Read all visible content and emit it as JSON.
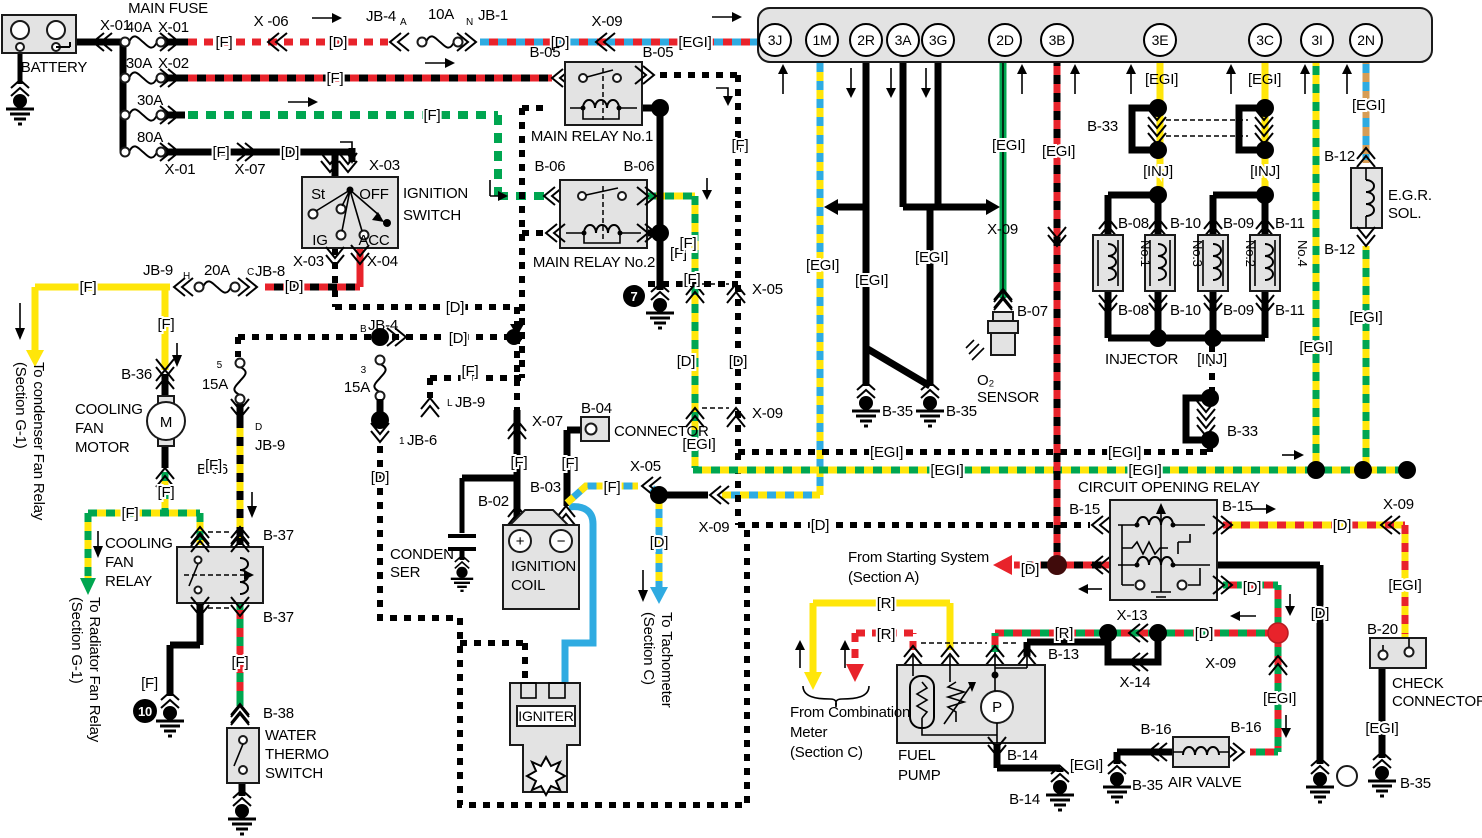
{
  "labels": {
    "F": "[F]",
    "D": "[D]",
    "R": "[R]",
    "EGI": "[EGI]",
    "INJ": "[INJ]"
  },
  "conn": {
    "X01": "X-01",
    "X02": "X-02",
    "X03": "X-03",
    "X04": "X-04",
    "X05": "X-05",
    "X06": "X -06",
    "X07": "X-07",
    "X09": "X-09",
    "X13": "X-13",
    "X14": "X-14",
    "JB1": "JB-1",
    "JB4": "JB-4",
    "JB6": "JB-6",
    "JB8": "JB-8",
    "JB9": "JB-9",
    "B02": "B-02",
    "B03": "B-03",
    "B04": "B-04",
    "B05": "B-05",
    "B06": "B-06",
    "B07": "B-07",
    "B08": "B-08",
    "B09": "B-09",
    "B10": "B-10",
    "B11": "B-11",
    "B12": "B-12",
    "B13": "B-13",
    "B14": "B-14",
    "B15": "B-15",
    "B16": "B-16",
    "B20": "B-20",
    "B33": "B-33",
    "B35": "B-35",
    "B36": "B-36",
    "B37": "B-37",
    "B38": "B-38"
  },
  "fuse": {
    "MAIN": "MAIN FUSE",
    "A10": "10A",
    "A15": "15A",
    "A20": "20A",
    "A30": "30A",
    "A40": "40A",
    "A80": "80A"
  },
  "sub": {
    "A": "A",
    "N": "N",
    "B": "B",
    "C": "C",
    "H": "H",
    "D": "D",
    "L": "L",
    "n1": "1",
    "n3": "3",
    "n5": "5"
  },
  "comp": {
    "battery": "BATTERY",
    "ign1": "IGNITION",
    "ign2": "SWITCH",
    "relay1": "MAIN RELAY No.1",
    "relay2": "MAIN RELAY No.2",
    "cfm1": "COOLING",
    "cfm2": "FAN",
    "cfm3": "MOTOR",
    "cfr1": "COOLING",
    "cfr2": "FAN",
    "cfr3": "RELAY",
    "wts1": "WATER",
    "wts2": "THERMO",
    "wts3": "SWITCH",
    "cond1": "CONDEN",
    "cond2": "SER",
    "coil1": "IGNITION",
    "coil2": "COIL",
    "igniter": "IGNITER",
    "connector": "CONNECTOR",
    "injector": "INJECTOR",
    "no1": "No.1",
    "no3": "No.3",
    "no2": "No.2",
    "no4": "No.4",
    "egr1": "E.G.R.",
    "egr2": "SOL.",
    "o2a": "O₂",
    "o2b": "SENSOR",
    "cor": "CIRCUIT OPENING RELAY",
    "fp1": "FUEL",
    "fp2": "PUMP",
    "av": "AIR VALVE",
    "cc1": "CHECK",
    "cc2": "CONNECTOR",
    "m": "M",
    "p": "P"
  },
  "sw": {
    "st": "St",
    "off": "OFF",
    "ig": "IG",
    "acc": "ACC"
  },
  "num": {
    "n7": "7",
    "n10": "10"
  },
  "ecu": {
    "pins": [
      "3J",
      "1M",
      "2R",
      "3A",
      "3G",
      "2D",
      "3B",
      "3E",
      "3C",
      "3I",
      "2N"
    ]
  },
  "notes": {
    "cond1": "To condenser Fan Relay",
    "cond2": "(Section G-1)",
    "rad1": "To Radiator Fan Relay",
    "rad2": "(Section G-1)",
    "tach1": "To Tachometer",
    "tach2": "(Section C)",
    "start1": "From Starting System",
    "start2": "(Section A)",
    "comb1": "From Combination",
    "comb2": "Meter",
    "comb3": "(Section C)"
  },
  "colors": {
    "red": "#e8232b",
    "green": "#00a650",
    "yellow": "#ffe60a",
    "blue": "#2fabe1",
    "tan": "#d79d55",
    "box_fill": "#e3e3e3",
    "black": "#000000"
  }
}
